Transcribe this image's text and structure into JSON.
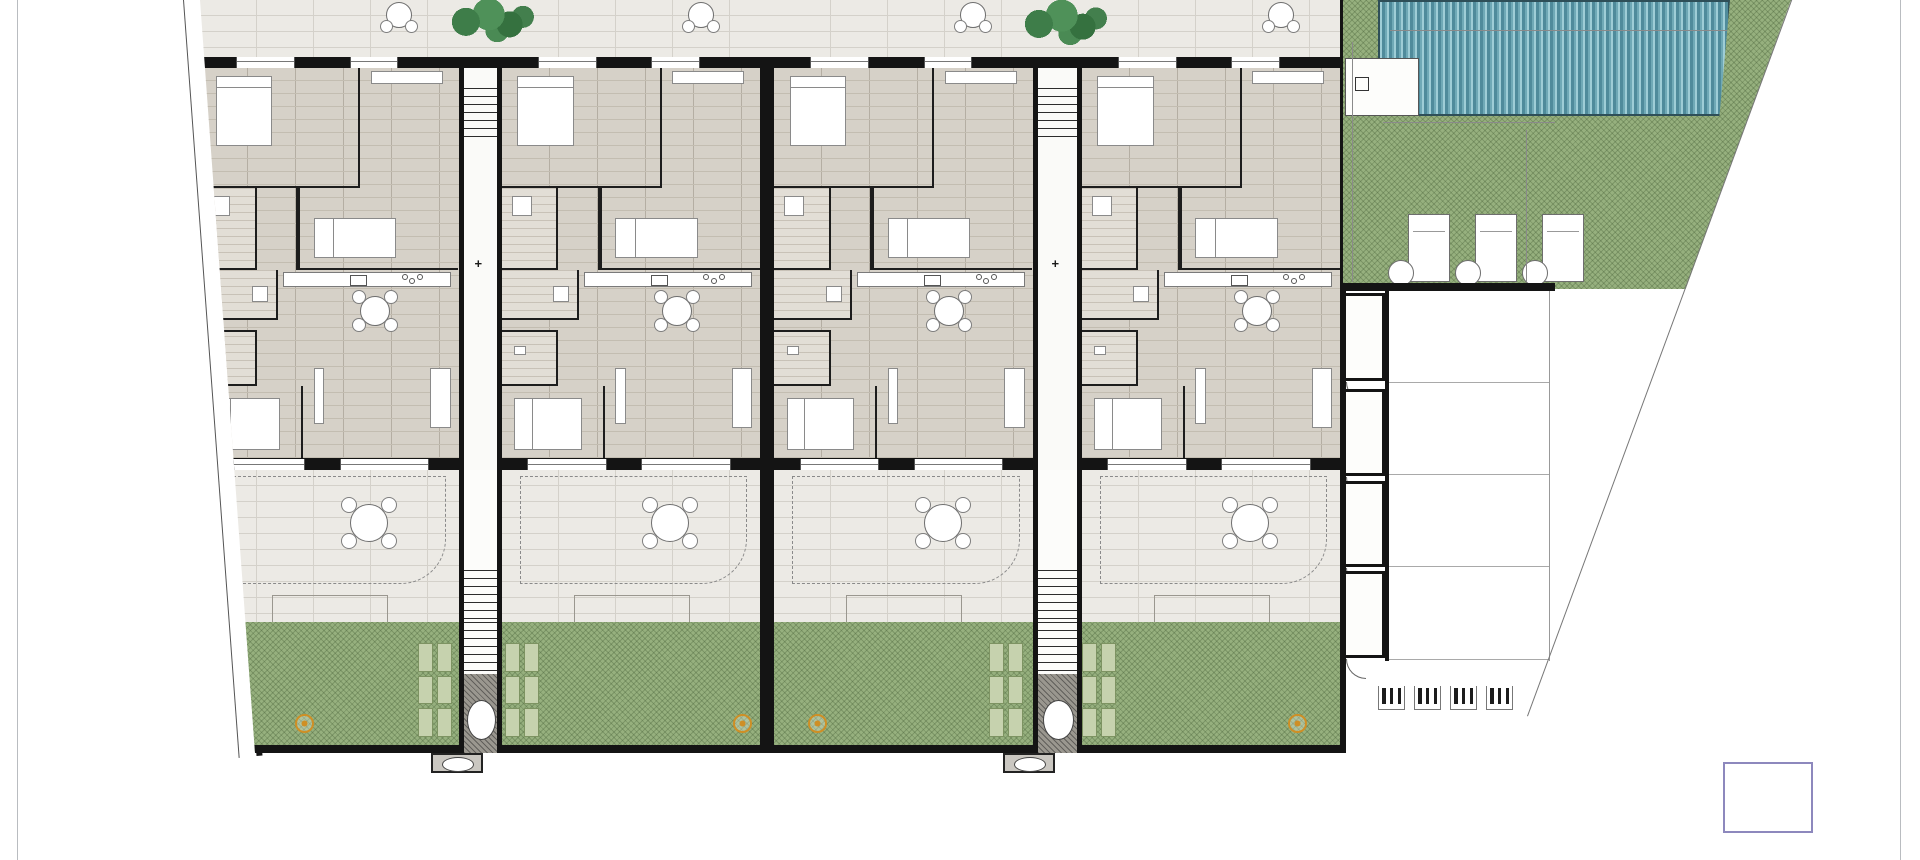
{
  "units": [
    {
      "plot_id": "P.01",
      "patio": {
        "name": "PATIO",
        "sup": "SUP. 25,20 M2"
      },
      "rooms": {
        "dorm2": {
          "name": "DORMITORIO 2",
          "sup": "SUP. 11,35 M2"
        },
        "dorm3": {
          "name": "DORMITORIO 3",
          "sup": "SUP. 10,25 M2"
        },
        "bano2": {
          "name": "BAÑO 2",
          "sup": "SUP. 3,90 M2"
        },
        "distrib": {
          "name": "DISTRIB.",
          "sup": "SUP. 1,15 M2"
        },
        "lavadero": {
          "name": "LAVADERO",
          "sup": "SUP. 2,05 M2"
        },
        "bano1": {
          "name": "BAÑO 1",
          "sup": "SUP. 3,65 M2"
        },
        "dorm1": {
          "name": "DORMITORIO 1",
          "sup": "SUP. 11,90 M2"
        },
        "salon": {
          "name": "SALON-COCINA",
          "sup": "SUP. 30,05 M2"
        }
      },
      "porche": {
        "name": "PORCHE DELANTERO",
        "sup": "SUP. 53,85 M2"
      }
    },
    {
      "plot_id": "P.02",
      "patio": {
        "name": "PATIO",
        "sup": "SUP. 24,35 M2"
      },
      "rooms": {
        "dorm2": {
          "name": "DORMITORIO 2",
          "sup": "SUP. 11,35 M2"
        },
        "dorm3": {
          "name": "DORMITORIO 3",
          "sup": "SUP. 10,25 M2"
        },
        "bano2": {
          "name": "BAÑO 2",
          "sup": "SUP. 3,90 M2"
        },
        "distrib": {
          "name": "DISTRIB.",
          "sup": "SUP. 1,15 M2"
        },
        "lavadero": {
          "name": "LAVADERO",
          "sup": "SUP. 2,05 M2"
        },
        "bano1": {
          "name": "BAÑO 1",
          "sup": "SUP. 3,65 M2"
        },
        "dorm1": {
          "name": "DORMITORIO 1",
          "sup": "SUP. 11,90 M2"
        },
        "salon": {
          "name": "SALON-COCINA",
          "sup": "SUP. 30,05 M2"
        }
      },
      "porche": {
        "name": "PORCHE DELANTERO",
        "sup": "SUP. 53,75 M2"
      }
    },
    {
      "plot_id": "P.03",
      "patio": {
        "name": "PATIO",
        "sup": "SUP. 25,00 M2"
      },
      "rooms": {
        "dorm2": {
          "name": "DORMITORIO 2",
          "sup": "SUP. 11,35 M2"
        },
        "dorm3": {
          "name": "DORMITORIO 3",
          "sup": "SUP. 10,25 M2"
        },
        "bano2": {
          "name": "BAÑO 2",
          "sup": "SUP. 3,90 M2"
        },
        "distrib": {
          "name": "DISTRIB.",
          "sup": "SUP. 1,15 M2"
        },
        "lavadero": {
          "name": "LAVADERO",
          "sup": "SUP. 2,05 M2"
        },
        "bano1": {
          "name": "BAÑO 1",
          "sup": "SUP. 3,70 M2"
        },
        "dorm1": {
          "name": "DORMITORIO 1",
          "sup": "SUP. 11,90 M2"
        },
        "salon": {
          "name": "SALON-COCINA",
          "sup": "SUP. 30,05 M2"
        }
      },
      "porche": {
        "name": "PORCHE DELANTERO",
        "sup": "SUP. 53,40 M2"
      }
    },
    {
      "plot_id": "P.04",
      "patio": {
        "name": "PATIO",
        "sup": "SUP. 24,25 M2"
      },
      "rooms": {
        "dorm2": {
          "name": "DORMITORIO 2",
          "sup": "SUP. 11,35 M2"
        },
        "dorm3": {
          "name": "DORMITORIO 3",
          "sup": "SUP. 10,25 M2"
        },
        "bano2": {
          "name": "BAÑO 2",
          "sup": "SUP. 3,90 M2"
        },
        "distrib": {
          "name": "DISTRIB.",
          "sup": "SUP. 1,15 M2"
        },
        "lavadero": {
          "name": "LAVADERO",
          "sup": "SUP. 2,05 M2"
        },
        "bano1": {
          "name": "BAÑO 1",
          "sup": "SUP. 3,70 M2"
        },
        "dorm1": {
          "name": "DORMITORIO 1",
          "sup": "SUP. 11,90 M2"
        },
        "salon": {
          "name": "SALON-COCINA",
          "sup": "SUP. 30,05 M2"
        }
      },
      "porche": {
        "name": "PORCHE DELANTERO",
        "sup": "SUP. 54,00 M2"
      }
    }
  ],
  "corridor": {
    "trastero_name": "TRASTERO",
    "trastero_sup": "SUP. 2,10 M2"
  },
  "right_zone": {
    "trasteros": [
      {
        "name": "TRASTERO",
        "sup": "SUP. 2,45 M2"
      },
      {
        "name": "TRASTERO",
        "sup": "SUP. 2,35 M2"
      },
      {
        "name": "TRASTERO",
        "sup": "SUP. 2,35 M2"
      },
      {
        "name": "TRASTERO",
        "sup": "SUP. 2,30 M2"
      }
    ],
    "parking_labels": [
      "P.08",
      "P.07",
      "P.06",
      "P.05"
    ],
    "dimensions": [
      "2,38",
      "1,1",
      "7,39",
      "9,47",
      "2,1",
      "7,39",
      "5,60",
      "4,6",
      "4,10",
      "1,2",
      "0,66"
    ]
  },
  "logo": {
    "top": "IMMO",
    "bottom_left": "MA",
    "plus": "+",
    "bottom_right": "S"
  },
  "colors": {
    "accent_purple": "#6f66a8",
    "accent_cyan": "#a8e6f2",
    "garden_green": "#96b07e",
    "pool_teal": "#4f8b9b",
    "marker_orange": "#cf8f25",
    "wall_black": "#141414"
  }
}
